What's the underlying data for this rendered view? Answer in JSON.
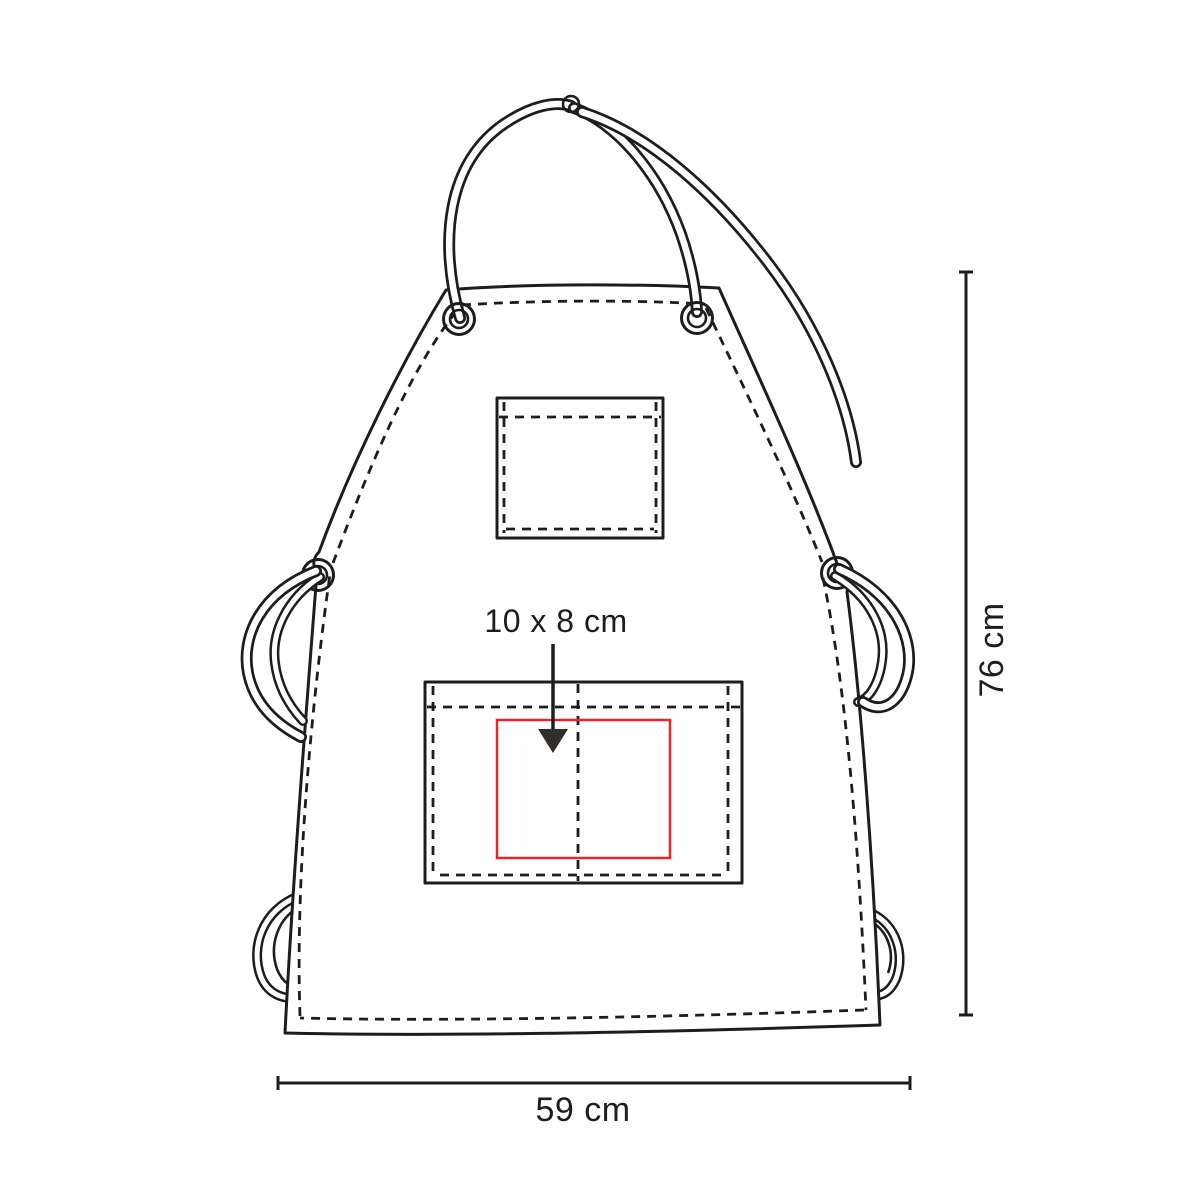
{
  "diagram": {
    "subject": "apron technical drawing",
    "labels": {
      "print_area": "10 x 8 cm",
      "height": "76 cm",
      "width": "59 cm"
    }
  },
  "colors": {
    "line": "#1d1d1b",
    "print_area": "#e8242d",
    "arrow": "#332e2b",
    "background": "#ffffff"
  }
}
